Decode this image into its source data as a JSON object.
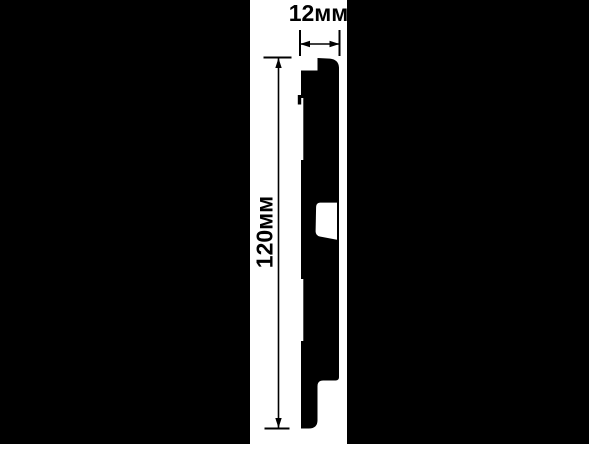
{
  "drawing": {
    "title": "panel-profile-cross-section",
    "width_dimension": {
      "label": "12мм",
      "value_mm": 12
    },
    "height_dimension": {
      "label": "120мм",
      "value_mm": 120
    },
    "colors": {
      "background_bars": "#000000",
      "canvas": "#ffffff",
      "ink": "#000000"
    }
  }
}
